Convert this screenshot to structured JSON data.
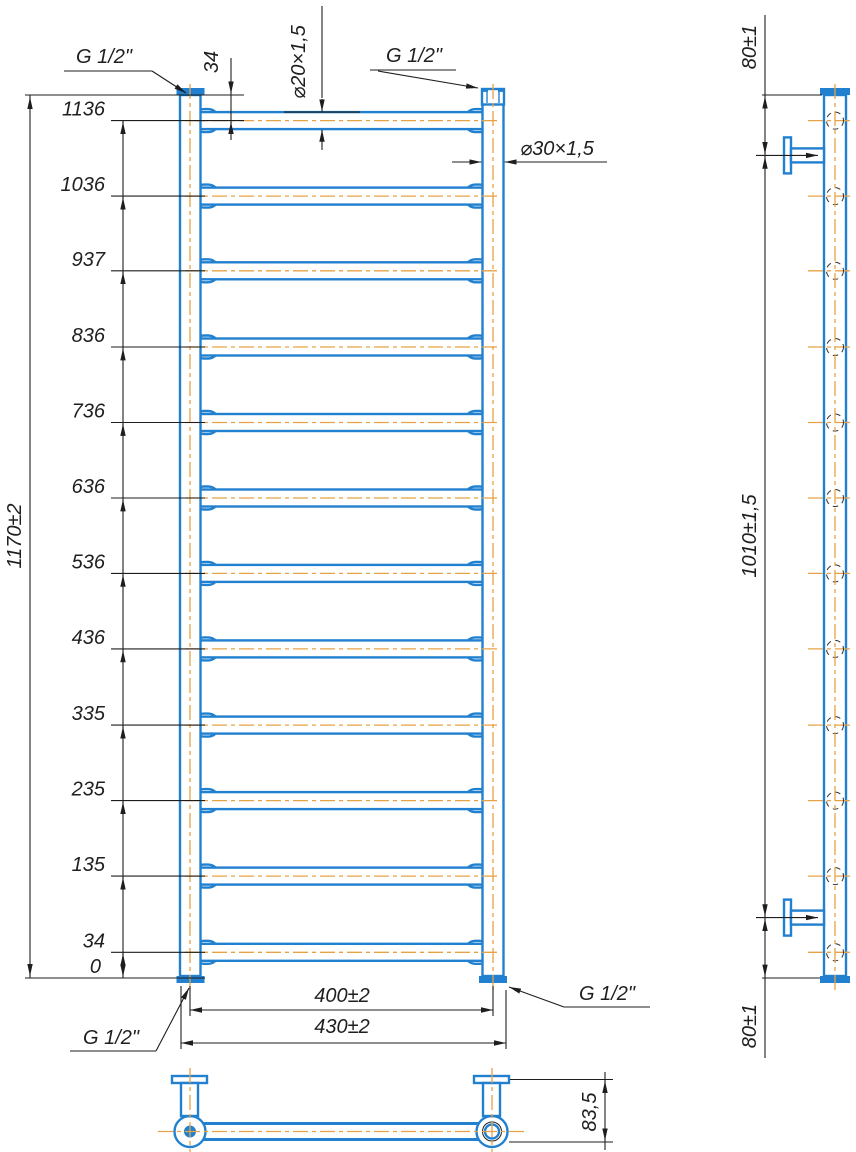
{
  "front_view": {
    "levels": [
      "1136",
      "1036",
      "937",
      "836",
      "736",
      "636",
      "536",
      "436",
      "335",
      "235",
      "135",
      "34",
      "0"
    ],
    "overall_height": "1170±2",
    "first_rung_offset": "34",
    "rung_tube": "⌀20×1,5",
    "collector_tube": "⌀30×1,5",
    "thread_top_left": "G 1/2\"",
    "thread_top_right": "G 1/2\"",
    "thread_bottom_left": "G 1/2\"",
    "thread_bottom_right": "G 1/2\"",
    "axis_width": "400±2",
    "overall_width": "430±2"
  },
  "side_view": {
    "top_bracket_offset": "80±1",
    "bracket_span": "1010±1,5",
    "bottom_bracket_offset": "80±1"
  },
  "bottom_view": {
    "depth": "83,5"
  },
  "colors": {
    "pipe_blue": "#2180cf",
    "centerline_orange": "#e8a245",
    "dimension_black": "#1e1e1e"
  }
}
